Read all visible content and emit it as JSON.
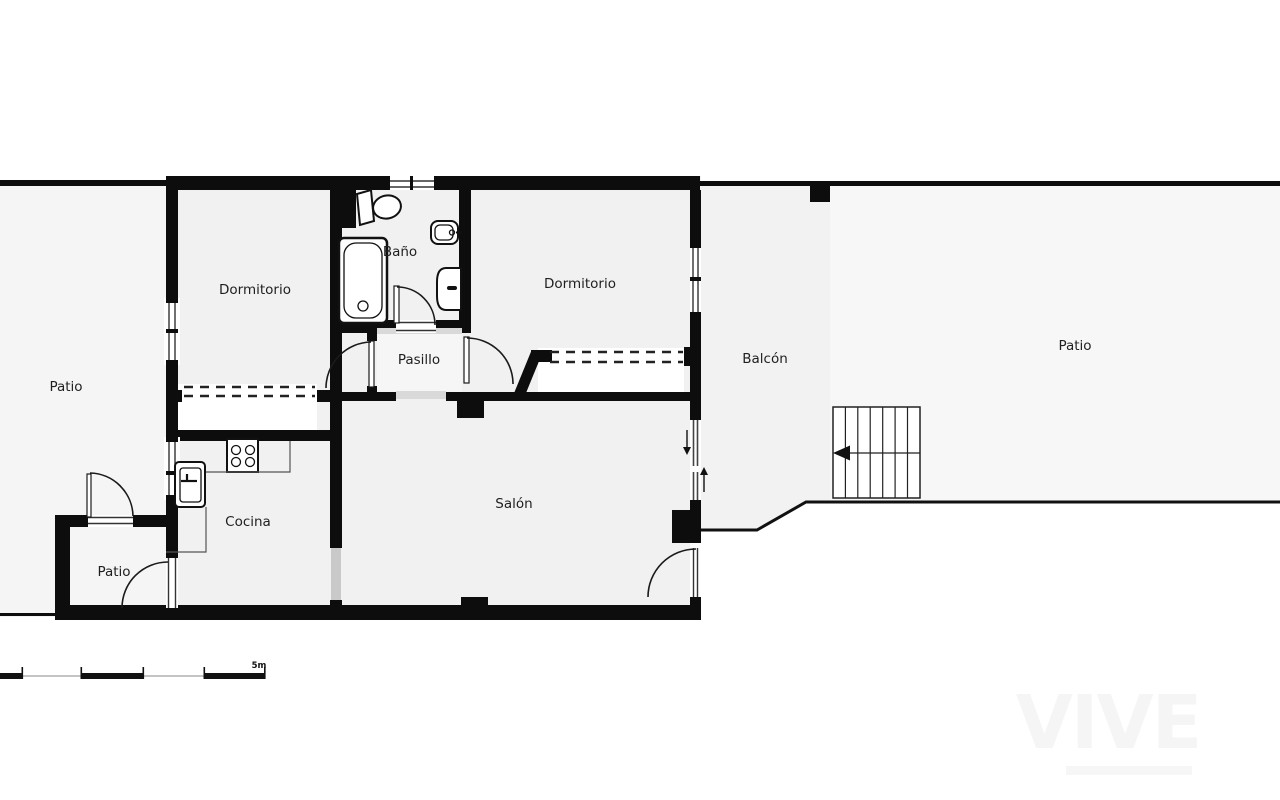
{
  "page": {
    "type": "floor-plan",
    "background": "#ffffff"
  },
  "rooms": [
    {
      "id": "patio-left",
      "label": "Patio"
    },
    {
      "id": "dormitorio-1",
      "label": "Dormitorio"
    },
    {
      "id": "bano",
      "label": "Baño"
    },
    {
      "id": "pasillo",
      "label": "Pasillo"
    },
    {
      "id": "dormitorio-2",
      "label": "Dormitorio"
    },
    {
      "id": "balcon",
      "label": "Balcón"
    },
    {
      "id": "patio-right",
      "label": "Patio"
    },
    {
      "id": "cocina",
      "label": "Cocina"
    },
    {
      "id": "salon",
      "label": "Salón"
    },
    {
      "id": "patio-small",
      "label": "Patio"
    }
  ],
  "scale_bar": {
    "label": "5m"
  },
  "watermark": {
    "text": "VIVE"
  },
  "colors": {
    "wall": "#0d0d0d",
    "room_floor": "#f1f1f1",
    "patio_floor": "#f5f5f5",
    "balcony_floor": "#f2f2f2",
    "outside": "#ffffff",
    "opening_gray": "#c9c9c9",
    "label_text": "#1f1f1f"
  },
  "fixtures": [
    "toilet",
    "washbasin",
    "bidet",
    "bathtub",
    "stove",
    "kitchen-sink",
    "stairs",
    "wardrobe-dashed",
    "sliding-door"
  ]
}
